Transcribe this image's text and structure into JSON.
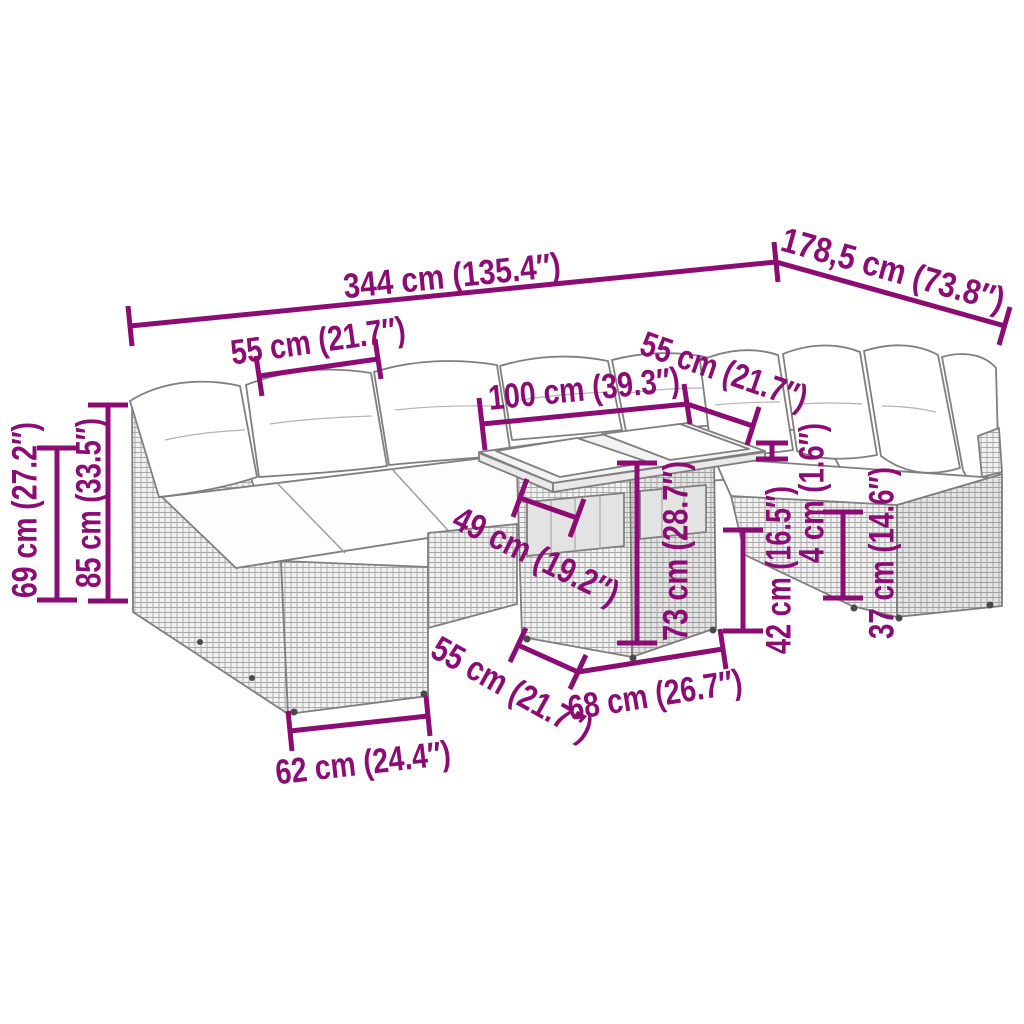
{
  "diagram": {
    "accent_color": "#8B0D73",
    "outline_color": "#7F7F7F",
    "background_color": "#FFFFFF",
    "dimensions": {
      "total_width": "344 cm (135.4″)",
      "total_depth": "178,5 cm (73.8″)",
      "left_seat_width": "55 cm (21.7″)",
      "table_top_width": "100 cm (39.3″)",
      "right_seat_width": "55 cm (21.7″)",
      "back_height": "69 cm (27.2″)",
      "total_height": "85 cm (33.5″)",
      "table_top_depth": "49 cm (19.2″)",
      "table_height": "73 cm (28.7″)",
      "table_top_thickness": "4 cm (1.6″)",
      "seat_height": "42 cm (16.5″)",
      "base_height": "37 cm (14.6″)",
      "seat_depth": "55 cm (21.7″)",
      "table_base_width": "68 cm (26.7″)",
      "armrest_base_width": "62 cm (24.4″)"
    }
  }
}
